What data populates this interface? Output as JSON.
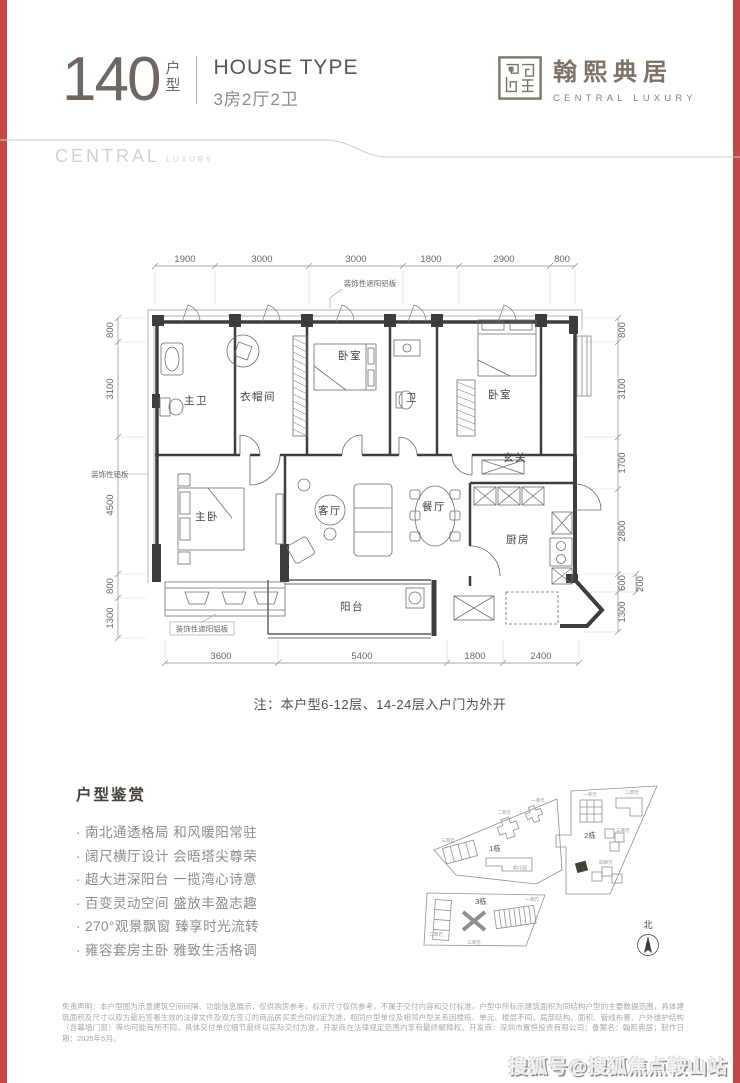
{
  "colors": {
    "edge_red": "#c2494a",
    "ink_dark": "#5c554f",
    "brand_ink": "#7b7268",
    "plan_line": "#3d3d3d",
    "muted_gray": "#8f8b86"
  },
  "header": {
    "number": "140",
    "unit_top": "户",
    "unit_bottom": "型",
    "subtitle_en": "HOUSE TYPE",
    "subtitle_cn": "3房2厅2卫"
  },
  "brand": {
    "name_cn": "翰熙典居",
    "name_en": "CENTRAL LUXURY"
  },
  "band": {
    "word_main": "CENTRAL",
    "word_sub": "LUXURY"
  },
  "floorplan": {
    "dims_top": [
      "1900",
      "3000",
      "3000",
      "1800",
      "2900",
      "800"
    ],
    "dims_left": [
      "800",
      "3100",
      "4500",
      "800",
      "1300"
    ],
    "dims_right": [
      "800",
      "3100",
      "1700",
      "2800",
      "600",
      "1300"
    ],
    "dim_right_offset": "200",
    "dims_bottom": [
      "3600",
      "5400",
      "1800",
      "2400"
    ],
    "rooms": {
      "master_bath": "主卫",
      "cloakroom": "衣帽间",
      "bedroom_a": "卧室",
      "bath": "卫",
      "bedroom_b": "卧室",
      "foyer": "玄关",
      "master_bedroom": "主卧",
      "living": "客厅",
      "dining": "餐厅",
      "kitchen": "厨房",
      "balcony": "阳台"
    },
    "annotations": {
      "top": "装饰性遮阳铝板",
      "left": "装饰性铝板",
      "bottom": "装饰性遮阳铝板"
    },
    "note": "注：本户型6-12层、14-24层入户门为外开"
  },
  "appreciation": {
    "title": "户型鉴赏",
    "bullets": [
      "南北通透格局 和风暖阳常驻",
      "阔尺横厅设计 会晤塔尖尊荣",
      "超大进深阳台 一揽湾心诗意",
      "百变灵动空间 盛放丰盈志趣",
      "270°观景飘窗 臻享时光流转",
      "雍容套房主卧 雅致生活格调"
    ]
  },
  "siteplan": {
    "block1": "1栋",
    "block2": "2栋",
    "block3": "3栋",
    "north": "北",
    "units": [
      "一单元",
      "二单元",
      "三单元",
      "幼儿园",
      "一单元",
      "二单元",
      "三单元",
      "四单元",
      "一单元",
      "二单元",
      "三单元"
    ]
  },
  "disclaimer": "免责声明：本户型图为示意建筑空间间隔、功能信息展示，仅供购房参考，标示尺寸仅供参考，不属于交付内容和交付标准，户型中所标示建筑面积为同结构户型的主要数据范围，具体建筑面积及尺寸以双方最后签署生效的法律文件及双方签订的商品房买卖合同约定为准，相同户型单位及相邻户型关系因楼栋、单元、楼层不同，局部结构、面积、管线布置、户外维护结构（含幕墙门窗）等均可能有所不同，具体交付单位细节最终以实际交付为准，开发商在法律规定范围内享有最终解释权。开发商：深圳市置恒投资有限公司；备案名：翰熙典居；制作日期：2025年5月。",
  "footer_watermark": "搜狐号@搜狐焦点鞍山站"
}
